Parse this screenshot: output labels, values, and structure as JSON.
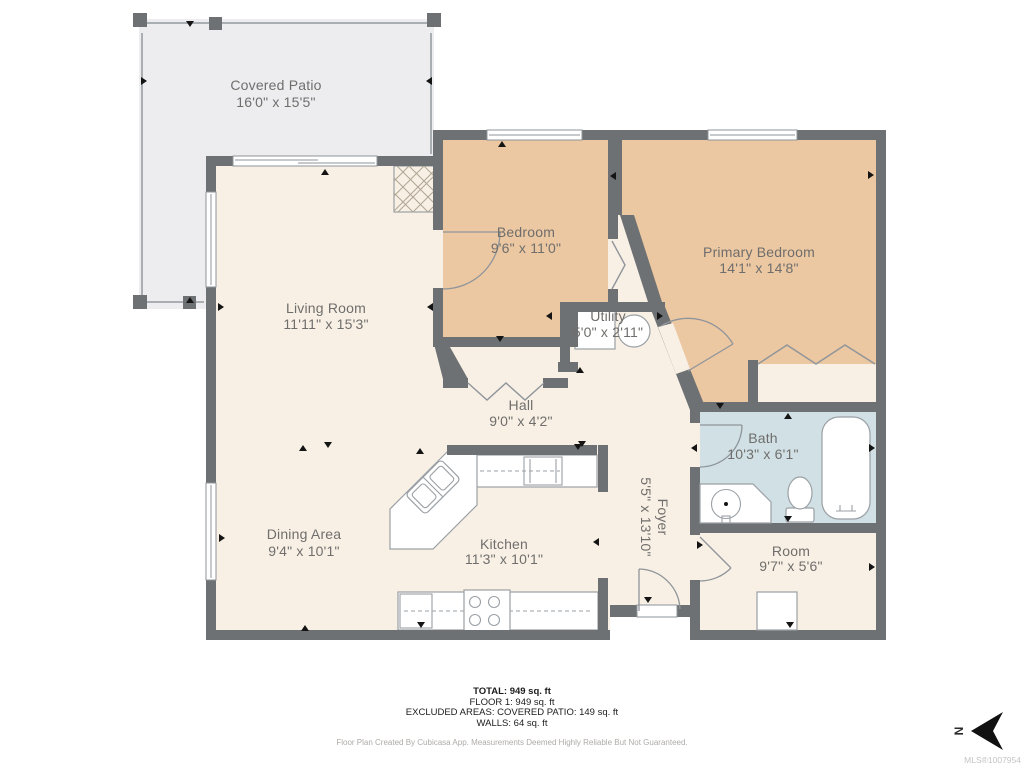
{
  "colors": {
    "wall": "#6e7173",
    "floor": "#f8f0e5",
    "bedroom": "#ebc7a2",
    "bath": "#d0e0e4",
    "patio": "#ededef",
    "patio_line": "#a9aeb3",
    "label": "#6f6e6c",
    "fixture": "#9aa0a5",
    "door": "#8f959a",
    "marker": "#141414",
    "hatch": "#b0a695",
    "text": "#1c1c1c",
    "disclaimer": "#aeaba8",
    "mls": "#c4c4c4"
  },
  "rooms": {
    "covered_patio": {
      "name": "Covered Patio",
      "dims": "16'0\" x 15'5\""
    },
    "living_room": {
      "name": "Living Room",
      "dims": "11'11\" x 15'3\""
    },
    "bedroom": {
      "name": "Bedroom",
      "dims": "9'6\" x 11'0\""
    },
    "primary_bedroom": {
      "name": "Primary Bedroom",
      "dims": "14'1\" x 14'8\""
    },
    "utility": {
      "name": "Utility",
      "dims": "5'0\" x 2'11\""
    },
    "hall": {
      "name": "Hall",
      "dims": "9'0\" x 4'2\""
    },
    "bath": {
      "name": "Bath",
      "dims": "10'3\" x 6'1\""
    },
    "dining_area": {
      "name": "Dining Area",
      "dims": "9'4\" x 10'1\""
    },
    "kitchen": {
      "name": "Kitchen",
      "dims": "11'3\" x 10'1\""
    },
    "foyer": {
      "name": "Foyer",
      "dims": "5'5\" x 13'10\""
    },
    "room": {
      "name": "Room",
      "dims": "9'7\" x 5'6\""
    }
  },
  "summary": {
    "total": "TOTAL: 949 sq. ft",
    "floor1": "FLOOR 1: 949 sq. ft",
    "excluded": "EXCLUDED AREAS: COVERED PATIO: 149 sq. ft",
    "walls": "WALLS: 64 sq. ft"
  },
  "disclaimer": "Floor Plan Created By Cubicasa App. Measurements Deemed Highly Reliable But Not Guaranteed.",
  "mls": "MLS®1007954",
  "compass": {
    "label": "N"
  }
}
